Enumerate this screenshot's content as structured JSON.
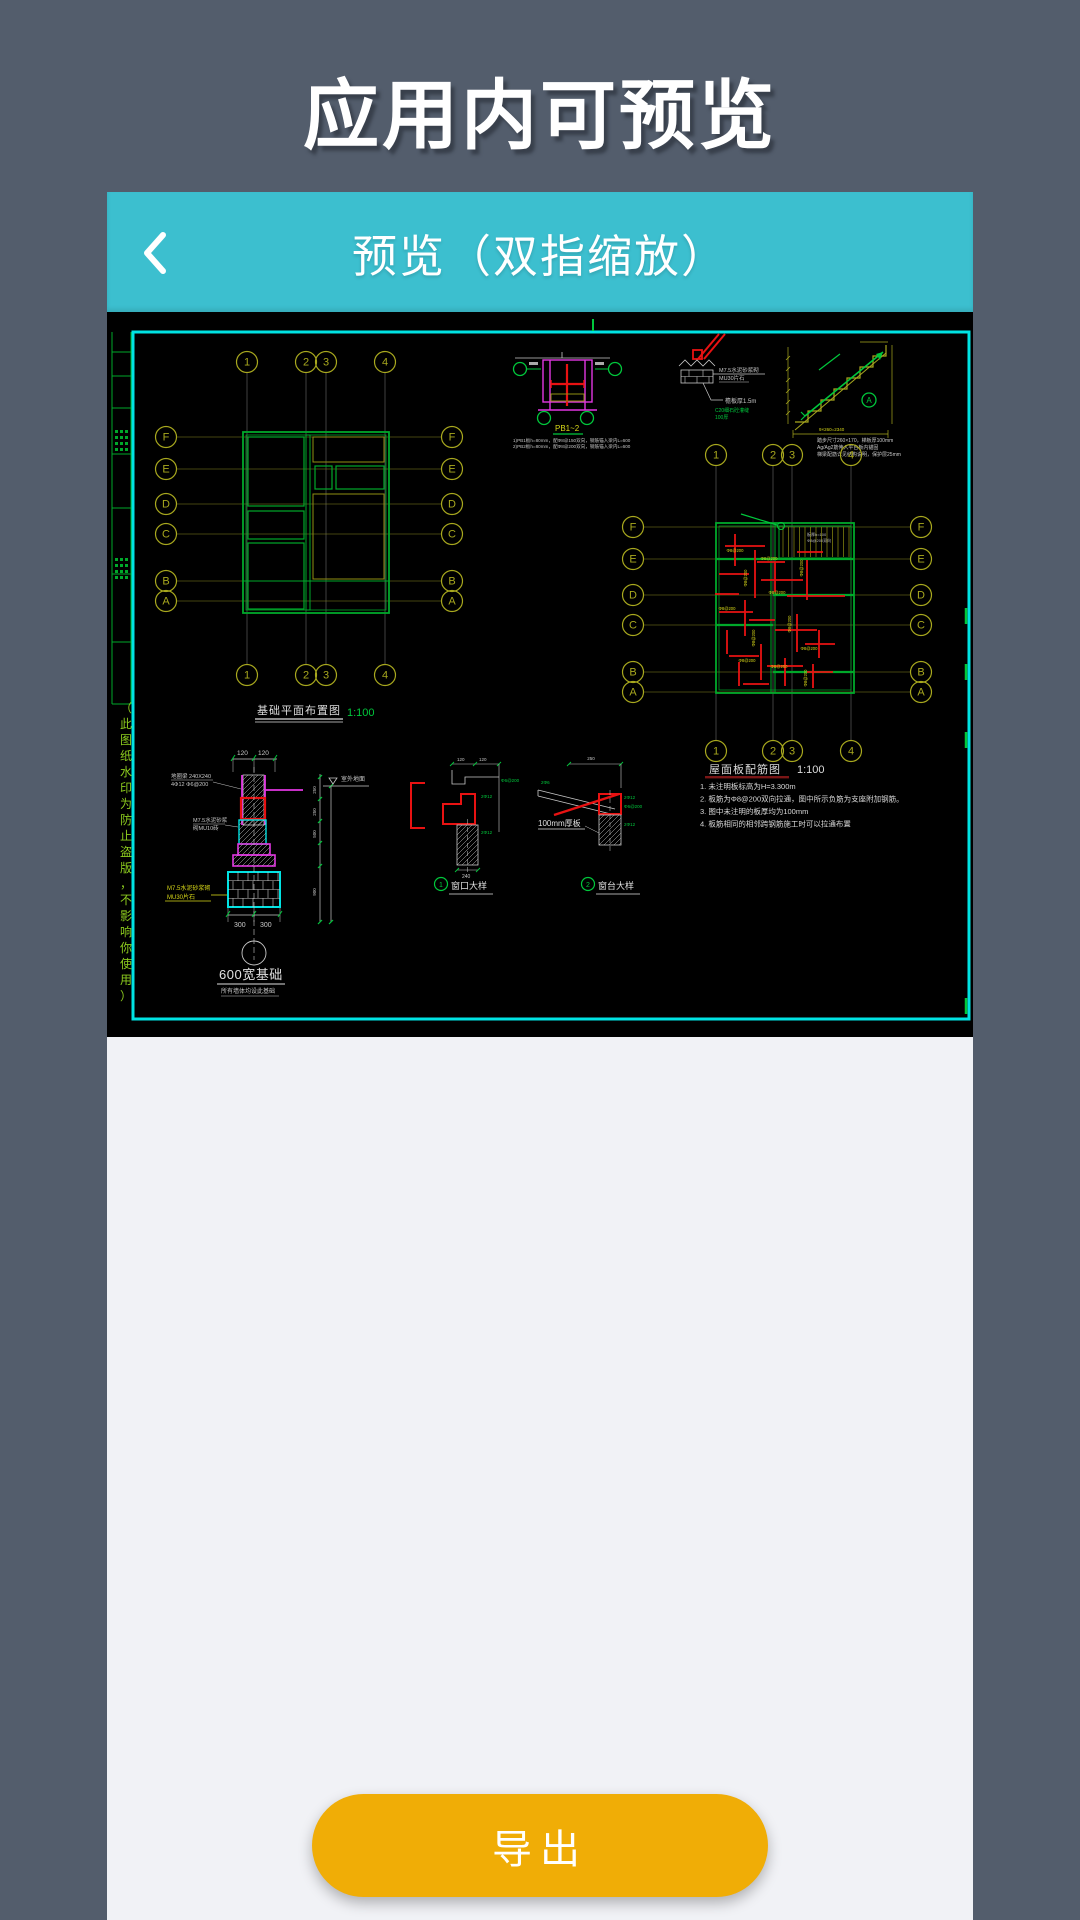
{
  "page": {
    "title": "应用内可预览"
  },
  "preview": {
    "header_title": "预览（双指缩放）",
    "export_label": "导出",
    "header_color": "#3CBFCF",
    "export_color": "#F0AD06"
  },
  "cad": {
    "watermark": "（此图纸水印为防止盗版，不影响你使用）",
    "rebar_label": "Φ8@200",
    "plan_foundation": {
      "title": "基础平面布置图",
      "scale": "1:100",
      "cols": [
        "1",
        "2",
        "3",
        "4"
      ],
      "rows": [
        "F",
        "E",
        "D",
        "C",
        "B",
        "A"
      ]
    },
    "plan_roof": {
      "title": "屋面板配筋图",
      "scale": "1:100",
      "cols": [
        "1",
        "2",
        "3",
        "4"
      ],
      "rows": [
        "F",
        "E",
        "D",
        "C",
        "B",
        "A"
      ],
      "notes": [
        "1. 未注明板标高为H=3.300m",
        "2. 板筋为Φ8@200双向拉通，图中所示负筋为支座附加钢筋。",
        "3. 图中未注明的板厚均为100mm",
        "4. 板筋相同的相邻跨钢筋施工时可以拉通布置"
      ],
      "stair_note1": "板厚h=100",
      "stair_note2": "Φ8@200双向"
    },
    "detail_pb": {
      "label": "PB1~2",
      "notes": [
        "1)PB1板h=80mm，配Φ8@150双向，钢筋锚入梁内L=600",
        "2)PB2板h=80mm，配Φ8@200双向，钢筋锚入梁内L=600"
      ]
    },
    "detail_eave": {
      "labels": [
        "M7.5水泥砂浆砌",
        "MU30片石",
        "檐板厚1.5m",
        "C20细石砼灌缝",
        "100厚"
      ]
    },
    "detail_stair": {
      "mark": "A",
      "dim": "9×260=2340",
      "notes": [
        "踏步尺寸260×170，梯板厚100mm",
        "Ag/Ag2筋伸入平台板内锚固",
        "梯梁配筋详见结构说明，保护层25mm"
      ]
    },
    "detail_foundation": {
      "ring_beam": "地圈梁 240X240",
      "ring_rebar": "4Φ12 Φ6@200",
      "mortar": "M7.5水泥砂浆",
      "brick": "砌MU10砖",
      "mortar2": "M7.5水泥砂浆砌",
      "stone": "MU30片石",
      "ground": "室外地面",
      "title": "600宽基础",
      "subtitle": "所有墙体均设此基础",
      "dims_top": [
        "120",
        "120"
      ],
      "dims_bottom": [
        "300",
        "300"
      ],
      "dims_right": [
        "250",
        "250",
        "500",
        "900"
      ]
    },
    "detail_window": {
      "index": "1",
      "title": "窗口大样",
      "dim_top": [
        "120",
        "120"
      ],
      "dim_bottom": "240",
      "rebar": [
        "Φ6@200",
        "2Φ12",
        "2Φ12"
      ]
    },
    "detail_sill": {
      "index": "2",
      "title": "窗台大样",
      "thick": "100mm厚板",
      "dim_top": "250",
      "rebar": [
        "2Φ6",
        "2Φ12",
        "Φ6@200",
        "2Φ12"
      ]
    }
  }
}
